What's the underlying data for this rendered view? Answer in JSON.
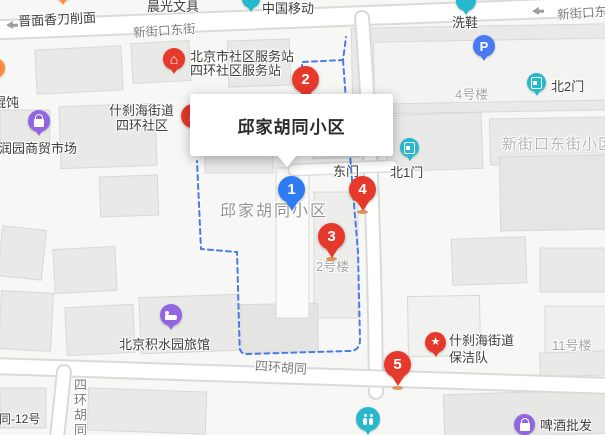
{
  "popup": {
    "title": "邱家胡同小区"
  },
  "markers": [
    {
      "label": "1",
      "color": "#2e7bf3"
    },
    {
      "label": "2",
      "color": "#e6392b"
    },
    {
      "label": "3",
      "color": "#e6392b"
    },
    {
      "label": "4",
      "color": "#e6392b"
    },
    {
      "label": "5",
      "color": "#e6392b"
    }
  ],
  "streets": {
    "xinjiekou_east_top": "新街口东街",
    "xinjiekou_east_topright": "新街口东街",
    "sihuan_hutong": "四环胡同",
    "sihuan_hutong_south": "四环胡同",
    "sihuan_hutong_no12": "四环胡同-12号"
  },
  "areas": {
    "qiujia_hutong_community": "邱家胡同小区",
    "xinjiekou_east_community": "新街口东街小区"
  },
  "buildings": {
    "no2": "2号楼",
    "no4": "4号楼",
    "no11": "11号楼"
  },
  "gates": {
    "east": "东门",
    "north1": "北1门",
    "north2": "北2门"
  },
  "pois": {
    "noodle_shop": "晋面香刀削面",
    "stationery": "晨光文具",
    "china_mobile": "中国移动",
    "shoe_wash": "洗鞋",
    "service_station_line1": "北京市社区服务站",
    "service_station_line2": "四环社区服务站",
    "wonton_shop": "馄饨",
    "shichahai_line1": "什刹海街道",
    "shichahai_line2": "四环社区",
    "market": "福润园商贸市场",
    "hotel": "北京积水园旅馆",
    "cleaning_team_line1": "什刹海街道",
    "cleaning_team_line2": "保洁队",
    "beer_wholesale": "啤酒批发"
  },
  "icon_glyphs": {
    "parking": "P",
    "service_station": "⌂",
    "cleaning_star": "★"
  },
  "colors": {
    "marker_red": "#e6392b",
    "marker_blue": "#2e7bf3",
    "gate_teal": "#26b8cd",
    "poi_purple": "#9265e2",
    "parking_blue": "#4a7af0",
    "poi_orange": "#ff8a3d",
    "boundary_blue": "#4b7ce6"
  }
}
